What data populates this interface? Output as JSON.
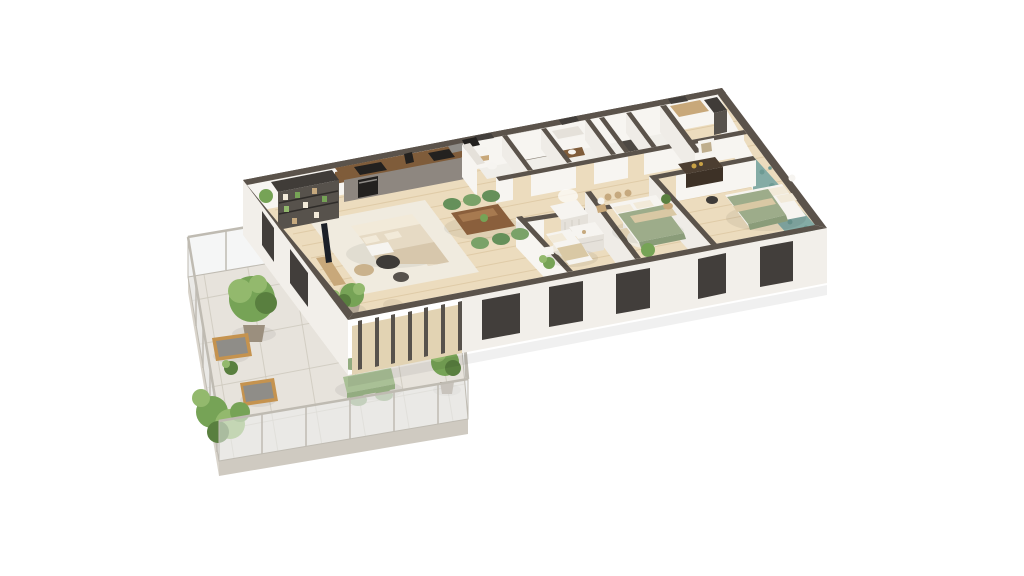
{
  "palette": {
    "bg": "#ffffff",
    "wall_top": "#5b534b",
    "wall_top_dark": "#463f39",
    "wall_face": "#f7f5f1",
    "wall_face_shade": "#efece7",
    "facade": "#f2efea",
    "window_recess": "#423e3b",
    "floor_wood": "#ecdcbe",
    "floor_wood_line": "#d9c29c",
    "floor_bath": "#f0eee9",
    "shower_tile": "#8d857b",
    "shower_dark": "#5f5950",
    "floor_laundry": "#4d4843",
    "terrace_tile": "#e7e3dc",
    "tile_line": "#cdc8bd",
    "slab_edge": "#d9d4cb",
    "slab_side": "#cfcac1",
    "glass": "rgba(236,239,239,0.55)",
    "glass_frame": "#bfbbb2",
    "rug": "#f0ebdf",
    "sofa": "#e6dac4",
    "sofa_shade": "#d7c7ac",
    "cushion": "#f2ead9",
    "table_dark": "#3e3b38",
    "table_wood": "#cab28c",
    "pouf": "#dfcfb2",
    "dining_table": "#8a5f3c",
    "dining_table_light": "#a77a50",
    "chair_green": "#7aa268",
    "chair_green_dark": "#65905a",
    "kitchen_front": "#8e8780",
    "kitchen_top": "#aca49b",
    "counter_wood": "#7f5c3a",
    "appliance_dark": "#23211f",
    "shelf_dark": "#403c38",
    "shelf_mid": "#57524c",
    "bed_white": "#f6f4f0",
    "bed_shade": "#e5e1da",
    "duvet_sage": "#9dac8a",
    "duvet_sage_dark": "#8a9c79",
    "duvet_stripe": "#d9c8a4",
    "wallpaper": "#84aba5",
    "wallpaper_dark": "#6d9a93",
    "dresser_dark": "#4c3e31",
    "dresser_dark_side": "#3d3126",
    "wood_light": "#c8a87a",
    "plant": "#76a356",
    "plant_light": "#93b96d",
    "plant_dark": "#597f3f",
    "pot": "#b4a897",
    "pot_dark": "#9b8f7e",
    "outdoor_green": "#a9c096",
    "outdoor_green_dark": "#93ac80",
    "outdoor_wood": "#c5934f",
    "cushion_gray": "#8f8d88",
    "basket": "#c6a97e",
    "gold": "#c9a246",
    "shadow": "rgba(0,0,0,0.06)",
    "canopy": "rgba(255,255,255,0.7)",
    "art": "#bfae8d"
  },
  "scene": {
    "type": "isometric-3d-floor-plan-render",
    "rooms": [
      {
        "name": "living-dining-kitchen",
        "furniture": [
          "corner-sofa",
          "coffee-tables",
          "pouf",
          "rug",
          "tv-console",
          "bookshelf",
          "kitchen-run",
          "dining-table",
          "six-green-chairs",
          "plants"
        ]
      },
      {
        "name": "terrace",
        "furniture": [
          "glass-railing",
          "outdoor-dining-table",
          "outdoor-chairs",
          "wooden-armchairs",
          "potted-trees",
          "shrubs"
        ]
      },
      {
        "name": "bathroom-block",
        "furniture": [
          "washbasin",
          "toilet",
          "shower",
          "bathtub",
          "vanity"
        ]
      },
      {
        "name": "laundry-closet",
        "furniture": [
          "washer"
        ]
      },
      {
        "name": "child-bedroom",
        "furniture": [
          "crib-with-canopy",
          "white-dresser",
          "single-bed",
          "shelf",
          "plants"
        ]
      },
      {
        "name": "bedroom-2",
        "furniture": [
          "double-bed-sage",
          "nightstand-lamp",
          "baskets-niche",
          "plants"
        ]
      },
      {
        "name": "master-bedroom",
        "furniture": [
          "double-bed-sage",
          "dark-dresser",
          "framed-art",
          "stool",
          "floral-wallpaper-wall"
        ]
      },
      {
        "name": "dressing",
        "furniture": [
          "wood-shelf",
          "dark-wardrobe"
        ]
      }
    ]
  }
}
